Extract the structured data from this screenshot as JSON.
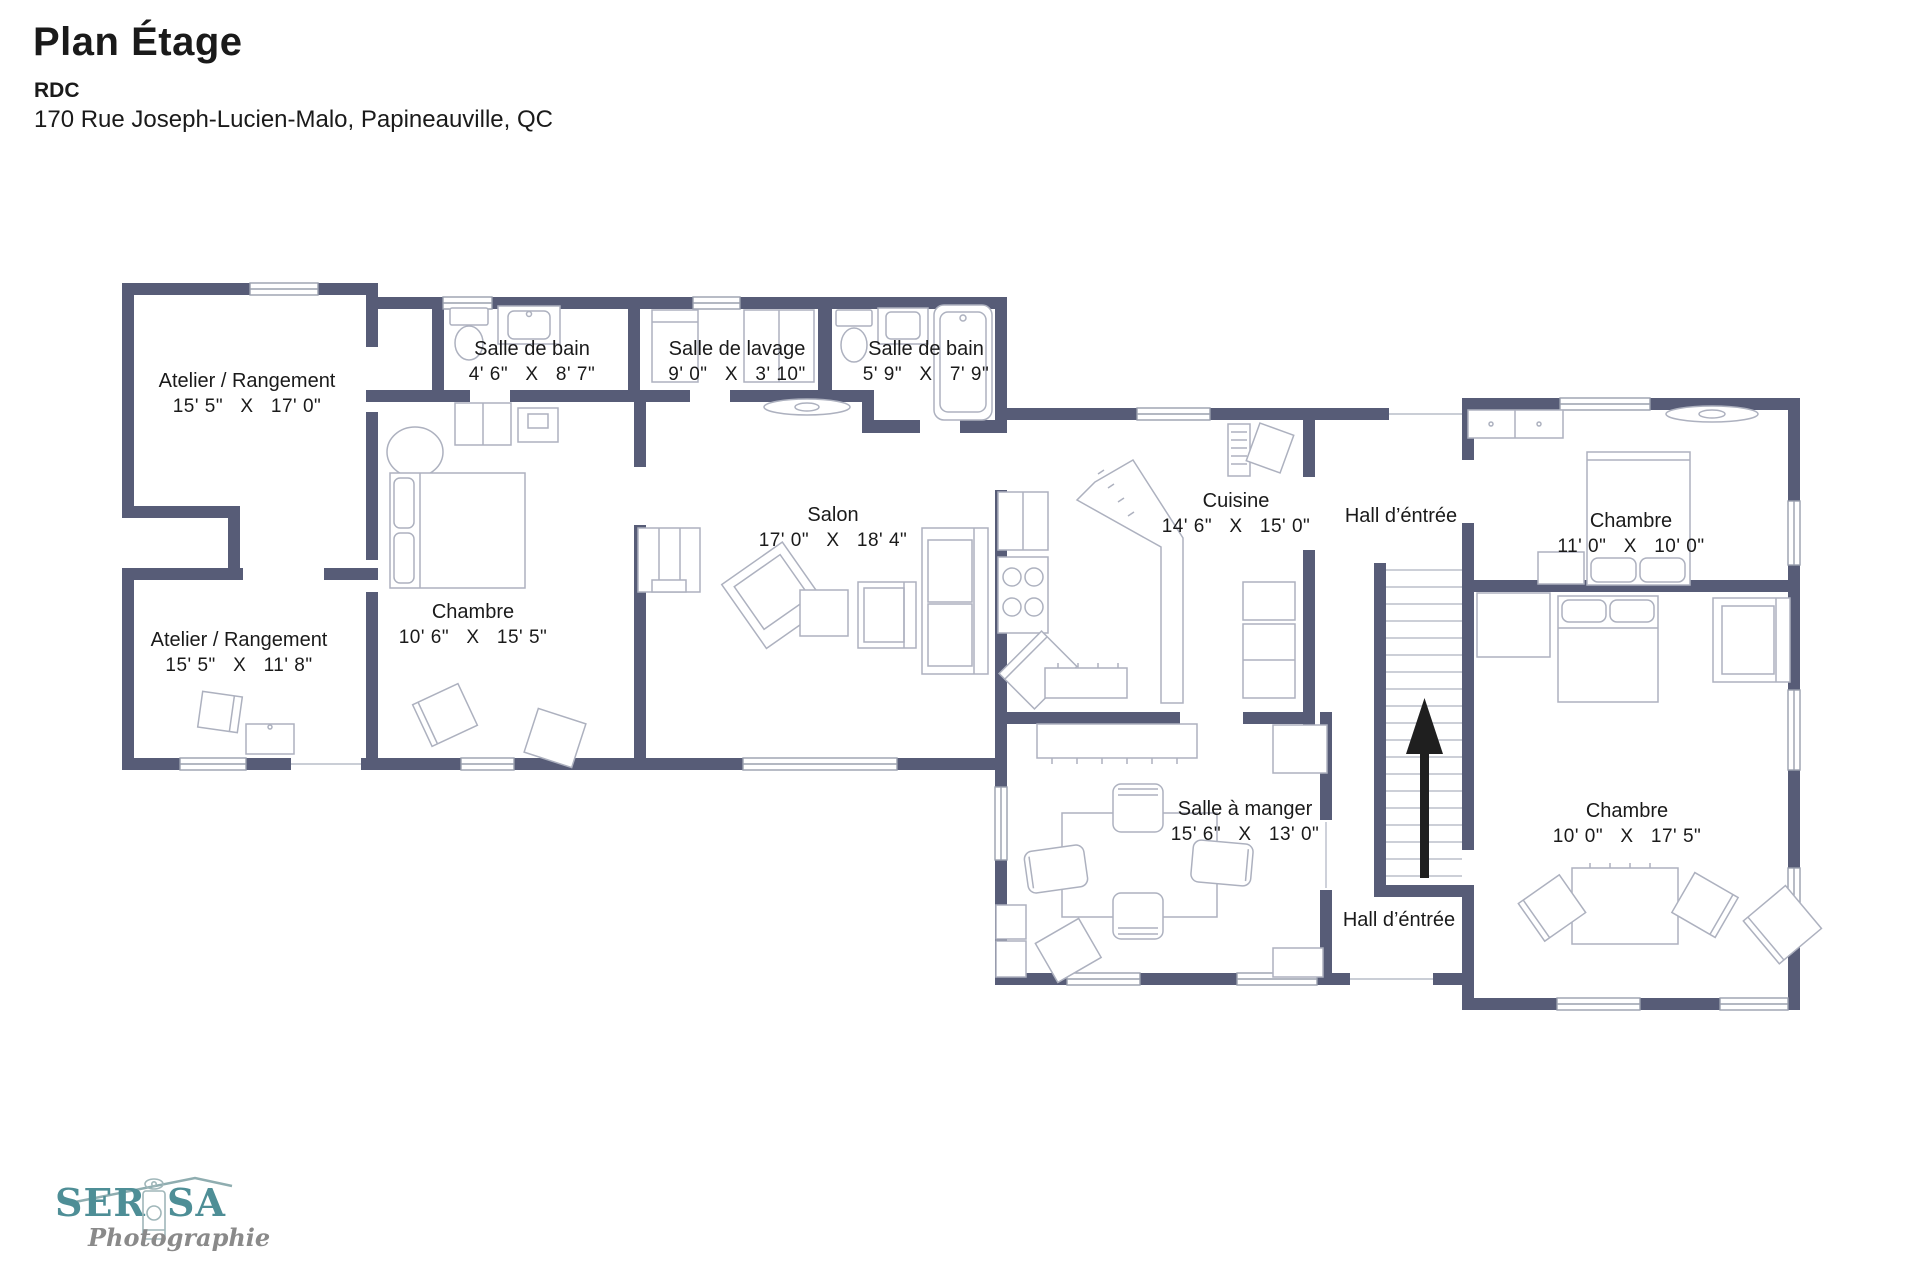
{
  "header": {
    "title": "Plan Étage",
    "level": "RDC",
    "address": "170 Rue Joseph-Lucien-Malo, Papineauville, QC"
  },
  "rooms": [
    {
      "name": "Atelier / Rangement",
      "dims": "15' 5\"   X   17' 0\""
    },
    {
      "name": "Salle de bain",
      "dims": "4' 6\"   X   8' 7\""
    },
    {
      "name": "Salle de lavage",
      "dims": "9' 0\"   X   3' 10\""
    },
    {
      "name": "Salle de bain",
      "dims": "5' 9\"   X   7' 9\""
    },
    {
      "name": "Salon",
      "dims": "17' 0\"   X   18' 4\""
    },
    {
      "name": "Cuisine",
      "dims": "14' 6\"   X   15' 0\""
    },
    {
      "name": "Hall d’éntrée",
      "dims": ""
    },
    {
      "name": "Chambre",
      "dims": "11' 0\"   X   10' 0\""
    },
    {
      "name": "Chambre",
      "dims": "10' 6\"   X   15' 5\""
    },
    {
      "name": "Atelier / Rangement",
      "dims": "15' 5\"   X   11' 8\""
    },
    {
      "name": "Salle à manger",
      "dims": "15' 6\"   X   13' 0\""
    },
    {
      "name": "Hall d’éntrée",
      "dims": ""
    },
    {
      "name": "Chambre",
      "dims": "10' 0\"   X   17' 5\""
    }
  ],
  "logo": {
    "brand_prefix": "SER",
    "brand_suffix": "SA",
    "tagline": "Photographie"
  },
  "colors": {
    "wall": "#575C77",
    "furniture_line": "#ADB1BF",
    "window_line": "#9AA0AE",
    "text": "#1A1A1A",
    "stair_arrow": "#1F1F1F",
    "logo_teal": "#4E8E96",
    "logo_gray": "#8A8A8A"
  }
}
